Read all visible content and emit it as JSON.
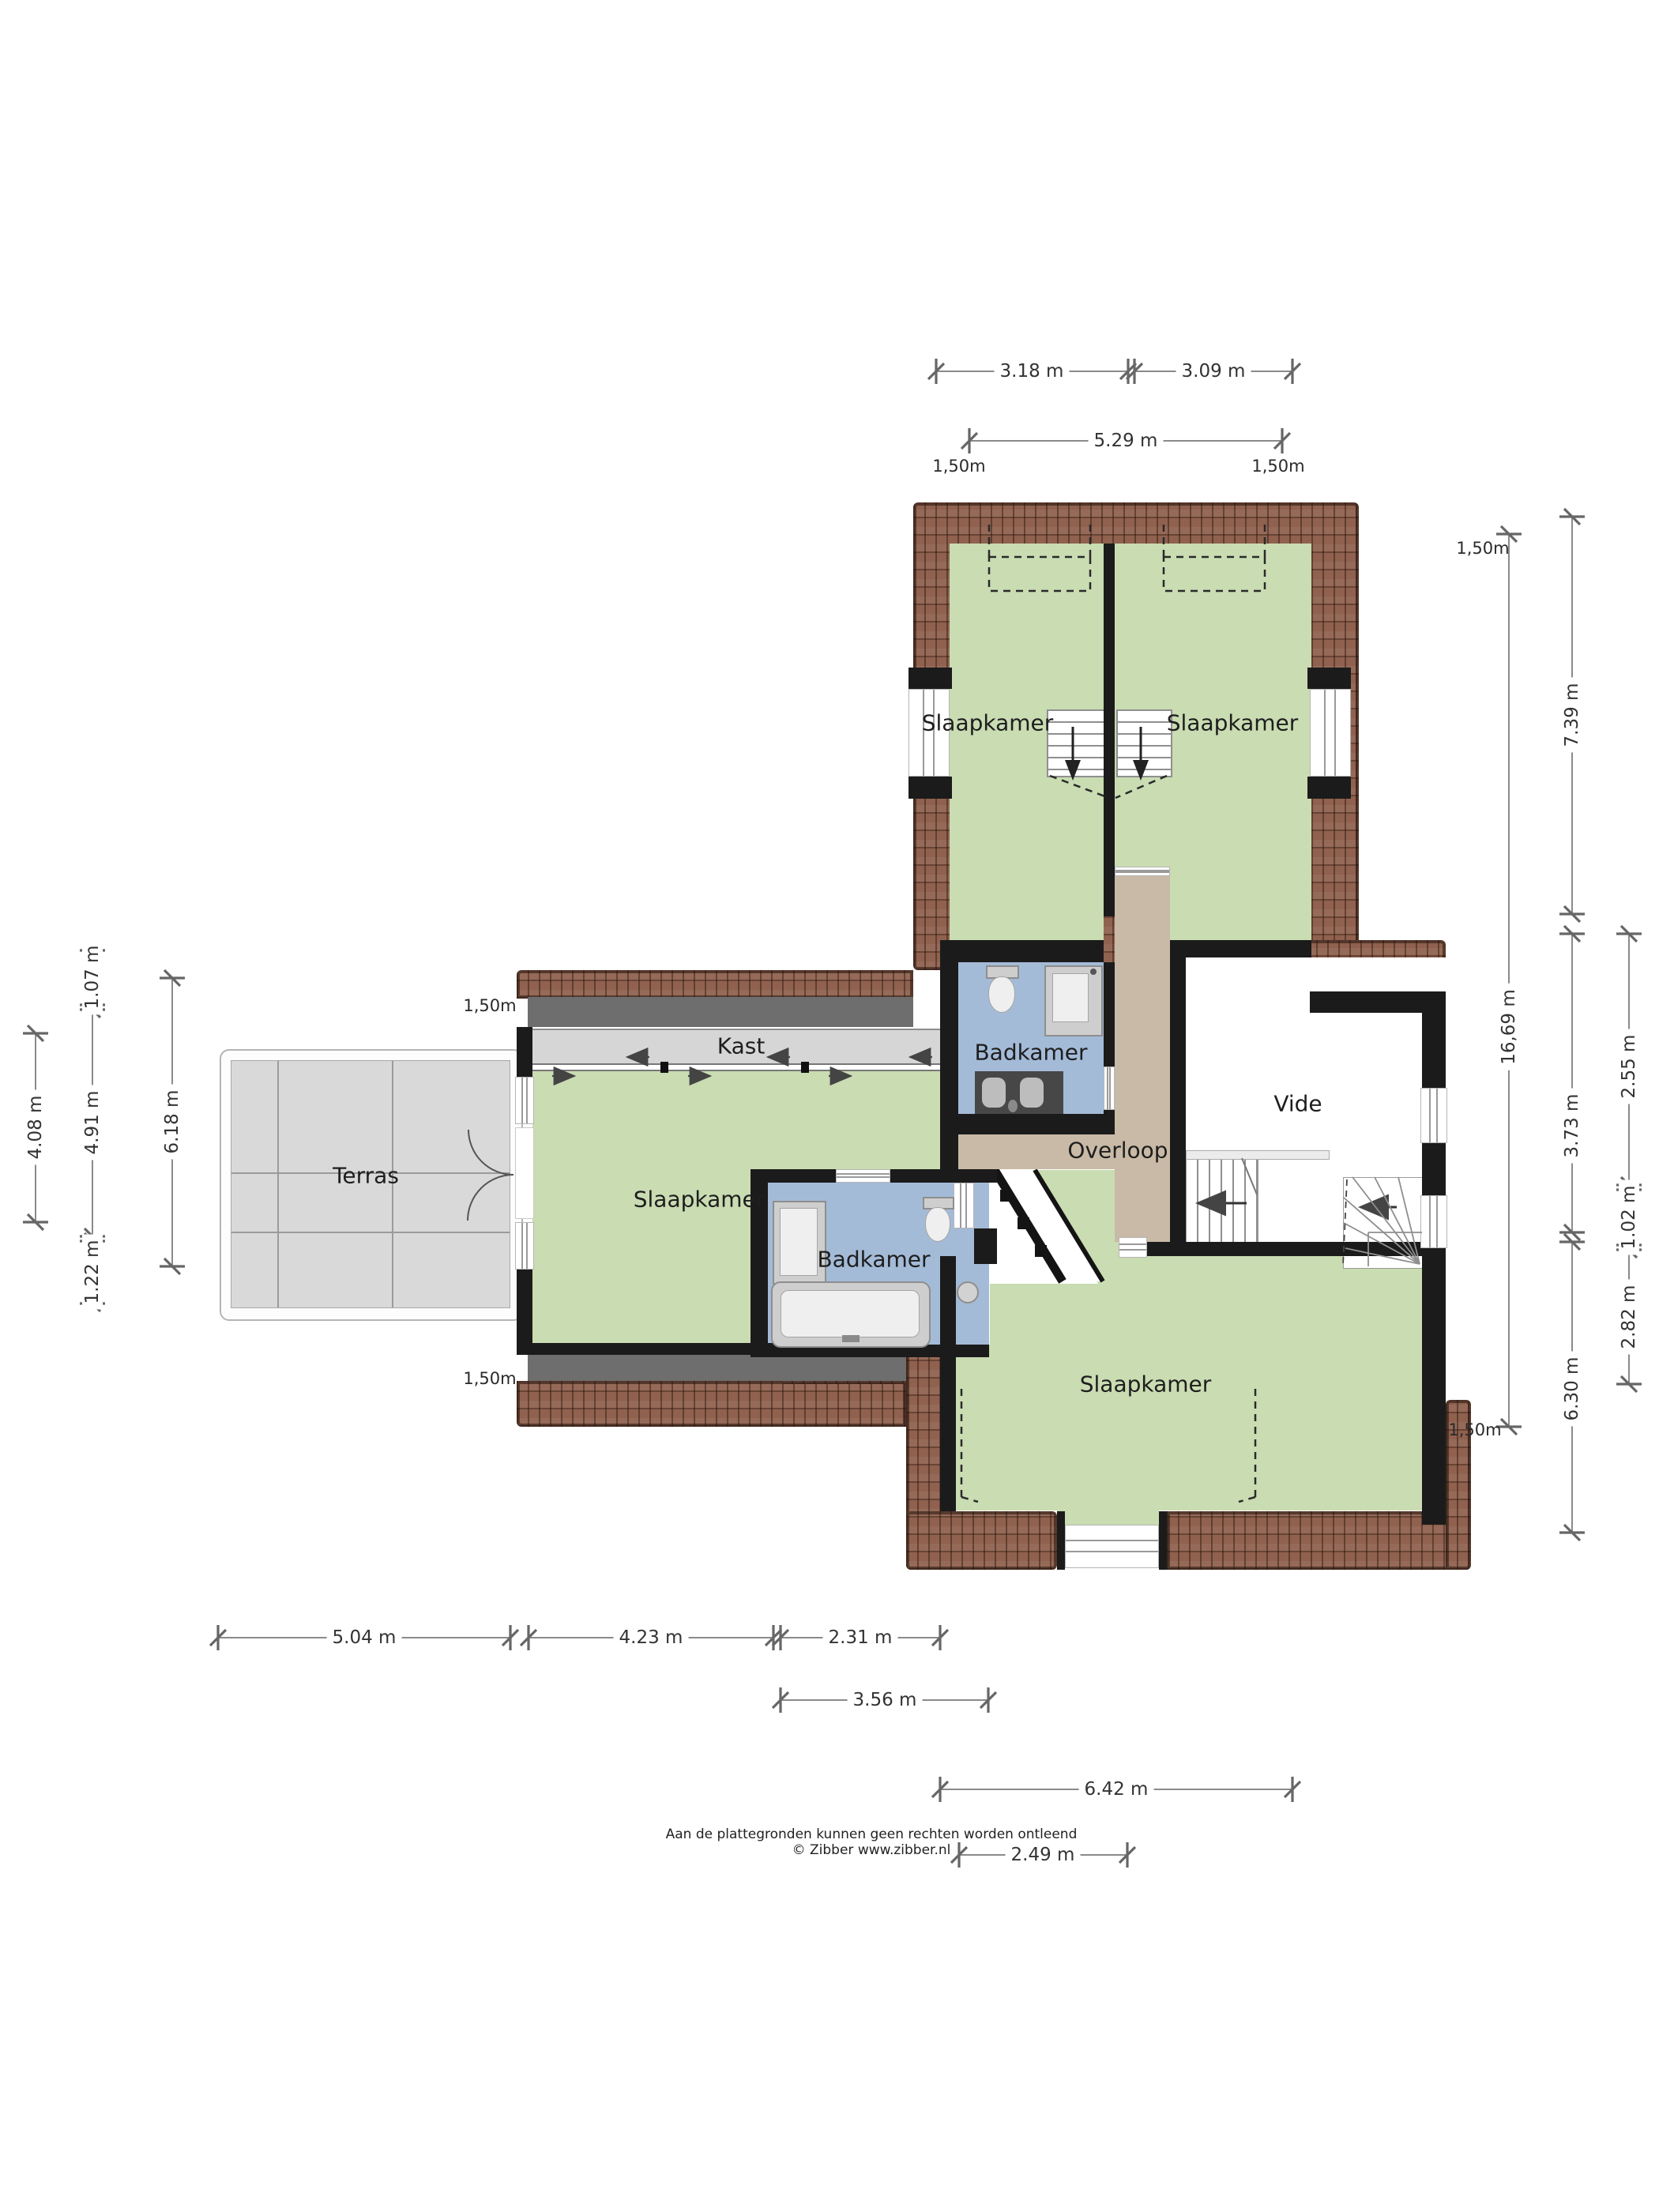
{
  "plan": {
    "title": "Floor plan first floor (verdieping)",
    "rooms": [
      {
        "id": "slaapkamer-nw",
        "label": "Slaapkamer"
      },
      {
        "id": "slaapkamer-ne",
        "label": "Slaapkamer"
      },
      {
        "id": "slaapkamer-w",
        "label": "Slaapkamer"
      },
      {
        "id": "slaapkamer-s",
        "label": "Slaapkamer"
      },
      {
        "id": "badkamer-n",
        "label": "Badkamer"
      },
      {
        "id": "badkamer-s",
        "label": "Badkamer"
      },
      {
        "id": "kast",
        "label": "Kast"
      },
      {
        "id": "vide",
        "label": "Vide"
      },
      {
        "id": "overloop",
        "label": "Overloop"
      },
      {
        "id": "terras",
        "label": "Terras"
      }
    ],
    "dimensions": {
      "top": [
        "3.18 m",
        "3.09 m",
        "5.29 m"
      ],
      "right": [
        "16,69 m",
        "7.39 m",
        "3.73 m",
        "6.30 m",
        "2.55 m",
        "1.02 m",
        "2.82 m"
      ],
      "left": [
        "4.08 m",
        "1.07 m",
        "4.91 m",
        "1.22 m",
        "6.18 m"
      ],
      "bottom": [
        "5.04 m",
        "4.23 m",
        "2.31 m",
        "3.56 m",
        "6.42 m",
        "2.49 m"
      ]
    },
    "headroom_marks": [
      "1,50m",
      "1,50m",
      "1,50m",
      "1,50m",
      "1,50m",
      "1,50m"
    ],
    "footer": {
      "disclaimer": "Aan de plattegronden kunnen geen rechten worden ontleend",
      "credit": "© Zibber www.zibber.nl"
    },
    "colors": {
      "room_green": "#c9dcb2",
      "bath_blue": "#a4bbd8",
      "hall_tan": "#c8baa6",
      "roof_brown": "#8f614e",
      "roof_line": "#4a2f26",
      "terrace_gray": "#d9d9d9",
      "wall_black": "#1b1b1b",
      "closet_gray": "#d6d6d6",
      "dim_line": "#8a8a8a"
    }
  }
}
